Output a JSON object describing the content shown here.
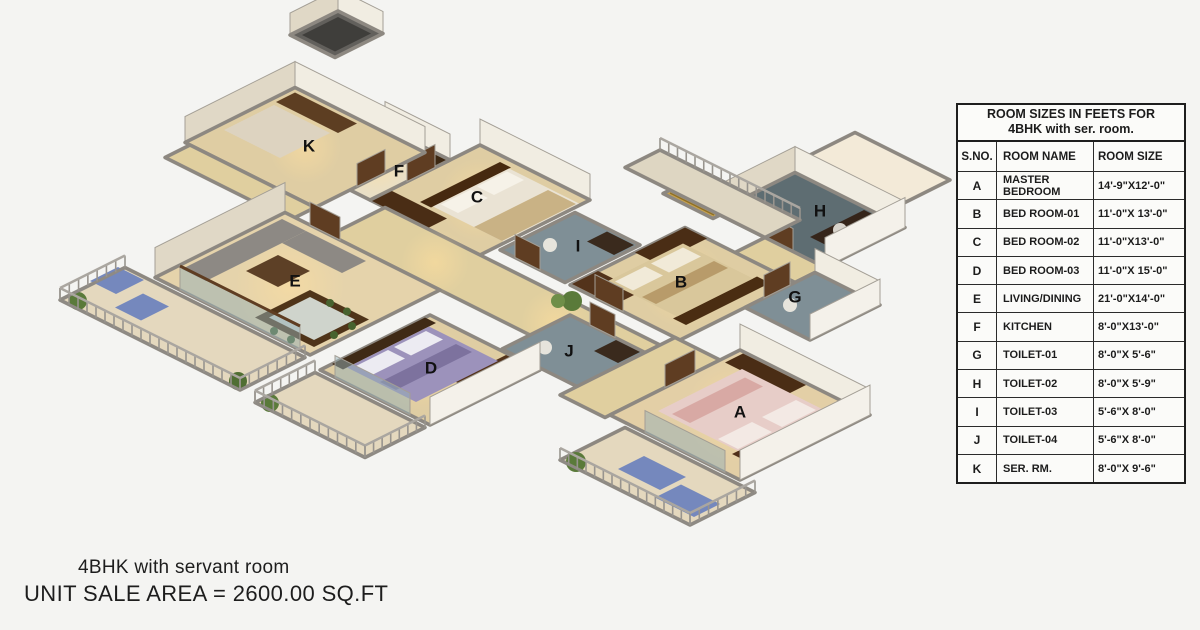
{
  "table": {
    "title_line1": "ROOM SIZES IN FEETS FOR",
    "title_line2": "4BHK with ser. room.",
    "columns": [
      "S.NO.",
      "ROOM NAME",
      "ROOM SIZE"
    ],
    "rows": [
      {
        "sno": "A",
        "name": "MASTER BEDROOM",
        "size": "14'-9\"X12'-0\""
      },
      {
        "sno": "B",
        "name": "BED ROOM-01",
        "size": "11'-0\"X 13'-0\""
      },
      {
        "sno": "C",
        "name": "BED ROOM-02",
        "size": "11'-0\"X13'-0\""
      },
      {
        "sno": "D",
        "name": "BED ROOM-03",
        "size": "11'-0\"X 15'-0\""
      },
      {
        "sno": "E",
        "name": "LIVING/DINING",
        "size": "21'-0\"X14'-0\""
      },
      {
        "sno": "F",
        "name": "KITCHEN",
        "size": "8'-0\"X13'-0\""
      },
      {
        "sno": "G",
        "name": "TOILET-01",
        "size": "8'-0\"X 5'-6\""
      },
      {
        "sno": "H",
        "name": "TOILET-02",
        "size": "8'-0\"X 5'-9\""
      },
      {
        "sno": "I",
        "name": "TOILET-03",
        "size": "5'-6\"X 8'-0\""
      },
      {
        "sno": "J",
        "name": "TOILET-04",
        "size": "5'-6\"X 8'-0\""
      },
      {
        "sno": "K",
        "name": "SER. RM.",
        "size": "8'-0\"X 9'-6\""
      }
    ]
  },
  "caption": {
    "line1": "4BHK with servant room",
    "line2": "UNIT SALE AREA = 2600.00 SQ.FT"
  },
  "floor_plan": {
    "room_labels": [
      "A",
      "B",
      "C",
      "D",
      "E",
      "F",
      "G",
      "H",
      "I",
      "J",
      "K"
    ]
  },
  "colors": {
    "background": "#f4f4f2",
    "floor_beige": "#dfcda3",
    "floor_beige_light": "#e9dfc6",
    "floor_tile_balcony": "#e4d8be",
    "tile_dark": "#5e6d72",
    "tile_mid": "#7f8f96",
    "wall_white": "#f1ede2",
    "wall_shaded": "#e0d8c6",
    "wall_cap_gray": "#8d8881",
    "wood_dark": "#4a2d15",
    "wood_frame": "#5f3d22",
    "label_black": "#111111",
    "table_line": "#1e1e1e",
    "text": "#1c1c1c",
    "glow_warm": "#ffdf9e",
    "plant_green": "#5a7a3a",
    "lounger_blue": "#7588bd"
  }
}
